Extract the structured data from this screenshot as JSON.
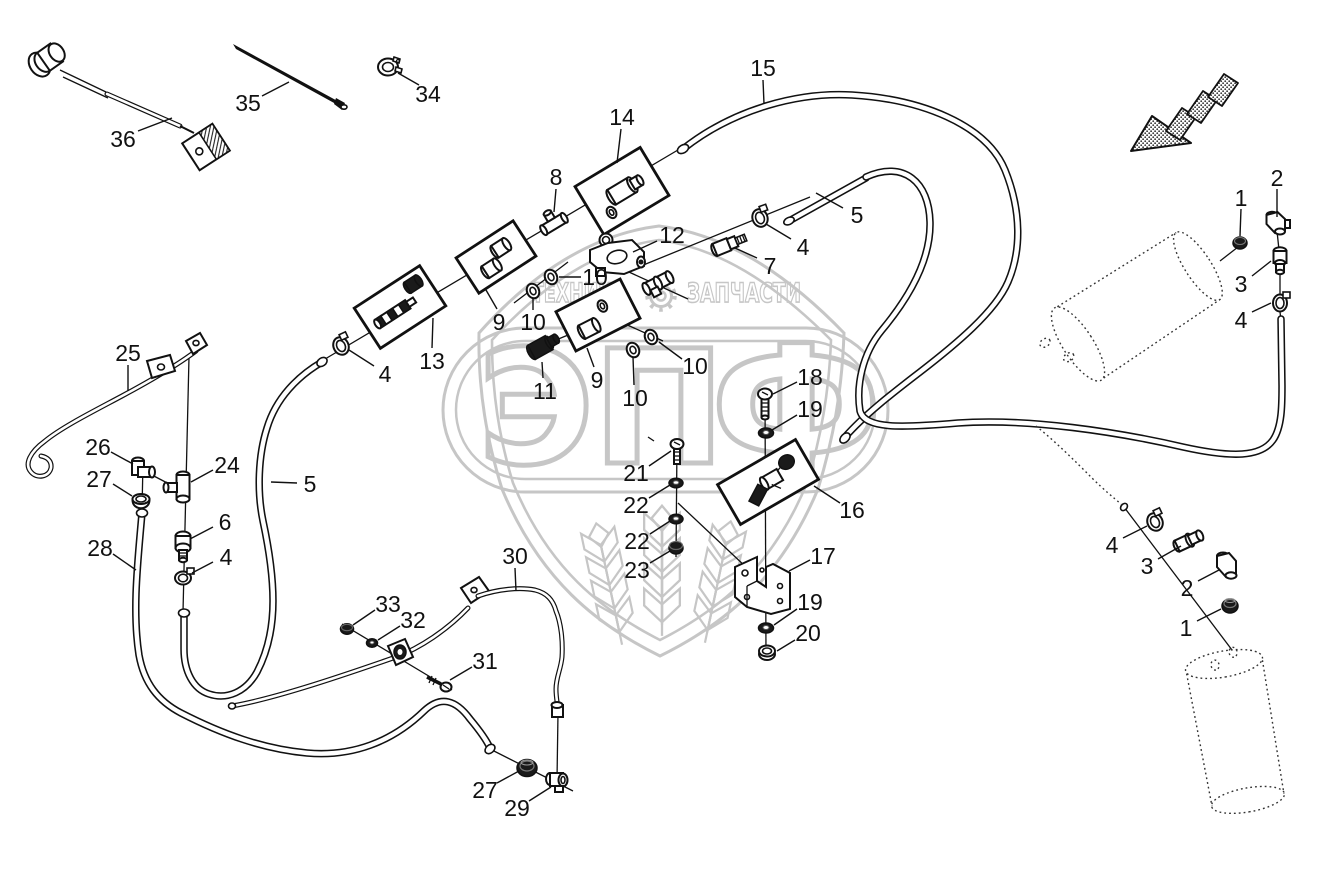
{
  "canvas": {
    "width": 1323,
    "height": 875,
    "background": "#ffffff"
  },
  "colors": {
    "ink": "#111111",
    "watermark": "#c6c6c6"
  },
  "figure": {
    "kind": "exploded-parts-diagram",
    "description_visible_text_only": true
  },
  "watermark": {
    "tagline_left": "ТЕХНИКА",
    "tagline_right": "ЗАПЧАСТИ",
    "brand_letters": [
      "Э",
      "П",
      "Ф"
    ],
    "gear_icon": "gear"
  },
  "labels": [
    {
      "text": "36",
      "x": 123,
      "y": 139,
      "leader": [
        138,
        131,
        172,
        118
      ]
    },
    {
      "text": "35",
      "x": 248,
      "y": 103,
      "leader": [
        262,
        96,
        289,
        82
      ]
    },
    {
      "text": "34",
      "x": 428,
      "y": 94,
      "leader": [
        419,
        85,
        398,
        73
      ]
    },
    {
      "text": "14",
      "x": 622,
      "y": 117,
      "leader": [
        621,
        129,
        617,
        163
      ]
    },
    {
      "text": "15",
      "x": 763,
      "y": 68,
      "leader": [
        763,
        80,
        764,
        104
      ]
    },
    {
      "text": "8",
      "x": 556,
      "y": 177,
      "leader": [
        556,
        189,
        554,
        212
      ]
    },
    {
      "text": "5",
      "x": 857,
      "y": 215,
      "leader": [
        843,
        208,
        816,
        193
      ]
    },
    {
      "text": "4",
      "x": 803,
      "y": 247,
      "leader": [
        791,
        239,
        766,
        224
      ]
    },
    {
      "text": "7",
      "x": 770,
      "y": 266,
      "leader": [
        757,
        258,
        735,
        248
      ]
    },
    {
      "text": "12",
      "x": 672,
      "y": 235,
      "leader": [
        657,
        241,
        633,
        252
      ]
    },
    {
      "text": "2",
      "x": 1277,
      "y": 178,
      "leader": [
        1277,
        189,
        1277,
        217
      ]
    },
    {
      "text": "1",
      "x": 1241,
      "y": 198,
      "leader": [
        1241,
        209,
        1240,
        236
      ]
    },
    {
      "text": "3",
      "x": 1241,
      "y": 284,
      "leader": [
        1252,
        276,
        1271,
        261
      ]
    },
    {
      "text": "4",
      "x": 1241,
      "y": 320,
      "leader": [
        1252,
        312,
        1271,
        303
      ]
    },
    {
      "text": "9",
      "x": 499,
      "y": 322,
      "leader": [
        497,
        309,
        486,
        290
      ]
    },
    {
      "text": "10",
      "x": 595,
      "y": 277,
      "leader": [
        581,
        277,
        559,
        277
      ]
    },
    {
      "text": "10",
      "x": 533,
      "y": 322,
      "leader": [
        533,
        310,
        533,
        298
      ]
    },
    {
      "text": "13",
      "x": 432,
      "y": 361,
      "leader": [
        432,
        348,
        433,
        318
      ]
    },
    {
      "text": "11",
      "x": 545,
      "y": 391,
      "leader": [
        543,
        378,
        542,
        362
      ]
    },
    {
      "text": "9",
      "x": 597,
      "y": 380,
      "leader": [
        594,
        367,
        587,
        348
      ]
    },
    {
      "text": "10",
      "x": 695,
      "y": 366,
      "leader": [
        682,
        359,
        659,
        342
      ]
    },
    {
      "text": "10",
      "x": 635,
      "y": 398,
      "leader": [
        634,
        385,
        633,
        357
      ]
    },
    {
      "text": "4",
      "x": 385,
      "y": 374,
      "leader": [
        374,
        366,
        349,
        350
      ]
    },
    {
      "text": "25",
      "x": 128,
      "y": 353,
      "leader": [
        128,
        365,
        128,
        391
      ]
    },
    {
      "text": "26",
      "x": 98,
      "y": 447,
      "leader": [
        111,
        452,
        133,
        464
      ]
    },
    {
      "text": "27",
      "x": 99,
      "y": 479,
      "leader": [
        113,
        484,
        132,
        496
      ]
    },
    {
      "text": "24",
      "x": 227,
      "y": 465,
      "leader": [
        213,
        470,
        191,
        482
      ]
    },
    {
      "text": "6",
      "x": 225,
      "y": 522,
      "leader": [
        213,
        527,
        190,
        539
      ]
    },
    {
      "text": "4",
      "x": 226,
      "y": 557,
      "leader": [
        213,
        562,
        192,
        573
      ]
    },
    {
      "text": "28",
      "x": 100,
      "y": 548,
      "leader": [
        113,
        554,
        136,
        570
      ]
    },
    {
      "text": "5",
      "x": 310,
      "y": 484,
      "leader": [
        297,
        483,
        271,
        482
      ]
    },
    {
      "text": "18",
      "x": 810,
      "y": 377,
      "leader": [
        797,
        382,
        773,
        394
      ]
    },
    {
      "text": "19",
      "x": 810,
      "y": 409,
      "leader": [
        797,
        415,
        772,
        430
      ]
    },
    {
      "text": "16",
      "x": 852,
      "y": 510,
      "leader": [
        840,
        503,
        814,
        486
      ]
    },
    {
      "text": "21",
      "x": 636,
      "y": 473,
      "leader": [
        649,
        466,
        671,
        451
      ]
    },
    {
      "text": "22",
      "x": 636,
      "y": 505,
      "leader": [
        649,
        498,
        670,
        485
      ]
    },
    {
      "text": "22",
      "x": 637,
      "y": 541,
      "leader": [
        650,
        534,
        670,
        521
      ]
    },
    {
      "text": "23",
      "x": 637,
      "y": 570,
      "leader": [
        650,
        563,
        670,
        551
      ]
    },
    {
      "text": "17",
      "x": 823,
      "y": 556,
      "leader": [
        810,
        560,
        789,
        571
      ]
    },
    {
      "text": "19",
      "x": 810,
      "y": 602,
      "leader": [
        797,
        609,
        774,
        625
      ]
    },
    {
      "text": "20",
      "x": 808,
      "y": 633,
      "leader": [
        795,
        640,
        777,
        651
      ]
    },
    {
      "text": "30",
      "x": 515,
      "y": 556,
      "leader": [
        515,
        568,
        516,
        591
      ]
    },
    {
      "text": "33",
      "x": 388,
      "y": 604,
      "leader": [
        375,
        610,
        353,
        625
      ]
    },
    {
      "text": "32",
      "x": 413,
      "y": 620,
      "leader": [
        400,
        626,
        378,
        640
      ]
    },
    {
      "text": "31",
      "x": 485,
      "y": 661,
      "leader": [
        472,
        667,
        450,
        680
      ]
    },
    {
      "text": "27",
      "x": 485,
      "y": 790,
      "leader": [
        497,
        783,
        519,
        771
      ]
    },
    {
      "text": "29",
      "x": 517,
      "y": 808,
      "leader": [
        529,
        801,
        551,
        787
      ]
    },
    {
      "text": "4",
      "x": 1112,
      "y": 545,
      "leader": [
        1123,
        538,
        1147,
        526
      ]
    },
    {
      "text": "3",
      "x": 1147,
      "y": 566,
      "leader": [
        1158,
        559,
        1181,
        546
      ]
    },
    {
      "text": "2",
      "x": 1187,
      "y": 588,
      "leader": [
        1198,
        581,
        1219,
        570
      ]
    },
    {
      "text": "1",
      "x": 1186,
      "y": 628,
      "leader": [
        1197,
        621,
        1221,
        609
      ]
    }
  ]
}
